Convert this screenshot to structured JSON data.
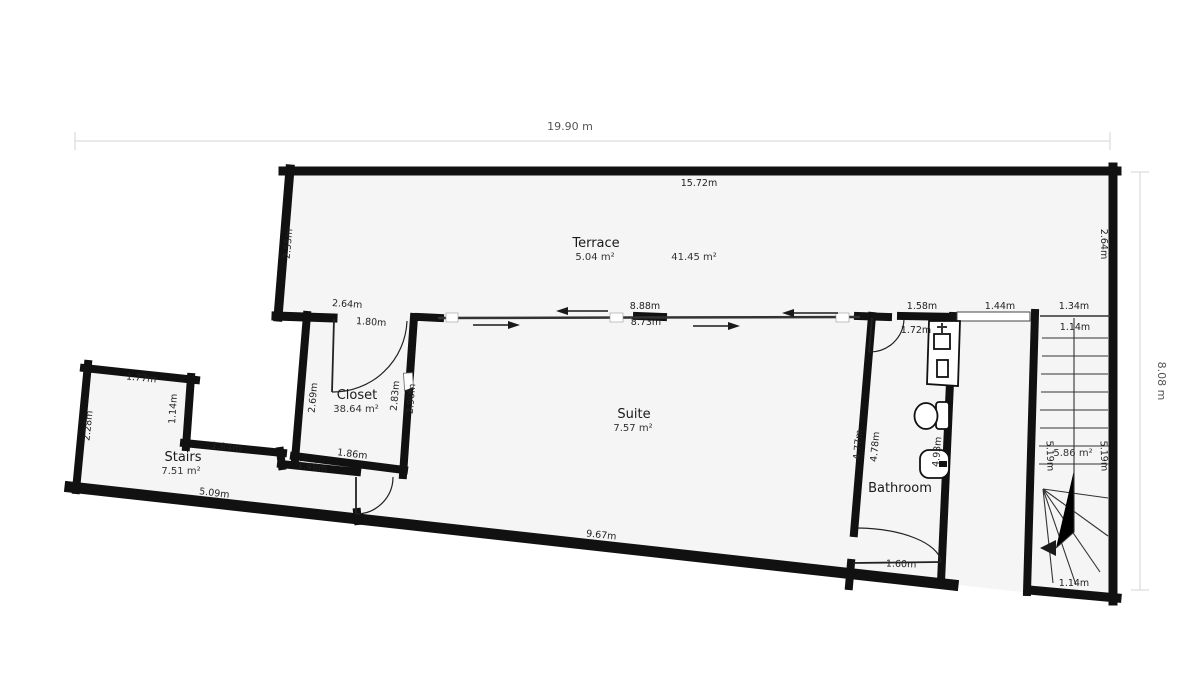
{
  "colors": {
    "wall": "#111111",
    "room_fill": "#f5f5f5",
    "dim_line": "#dddddd",
    "dim_text": "#555555",
    "label_text": "#1a1a1a"
  },
  "overall": {
    "width_label": "19.90 m",
    "height_label": "8.08 m"
  },
  "rooms": {
    "terrace": {
      "name": "Terrace",
      "area": "5.04 m²"
    },
    "level": {
      "area": "41.45 m²"
    },
    "suite": {
      "name": "Suite",
      "area": "7.57 m²"
    },
    "closet": {
      "name": "Closet",
      "area": "38.64 m²"
    },
    "stairs": {
      "name": "Stairs",
      "area": "7.51 m²"
    },
    "bathroom": {
      "name": "Bathroom"
    },
    "stairwell": {
      "area": "5.86 m²"
    }
  },
  "dims": {
    "terrace_top": "15.72m",
    "terrace_left": "2.55m",
    "terrace_right": "2.64m",
    "closet_door_outer": "2.64m",
    "closet_door_inner": "1.80m",
    "slider_outer": "8.88m",
    "slider_inner": "8.73m",
    "bath_top_wall": "1.58m",
    "opening_top": "1.44m",
    "stair_top_outer": "1.34m",
    "stair_top_inner": "1.14m",
    "bath_door_top": "1.72m",
    "closet_left": "2.69m",
    "closet_right_upper": "2.83m",
    "closet_right_lower": "2.90m",
    "stairs_top": "1.77m",
    "stairs_notch": "1.14m",
    "stairs_left": "2.28m",
    "stairs_step": "1.84m",
    "closet_bottom": "1.86m",
    "stairs_inner": "1.48m",
    "stairs_bottom": "5.09m",
    "suite_bottom": "9.67m",
    "suite_right_outer": "4.77m",
    "suite_right_inner": "4.78m",
    "bath_right": "4.93m",
    "bath_door_bottom": "1.60m",
    "stairwell_left": "5.19m",
    "stairwell_right": "5.19m",
    "stair_bottom": "1.14m"
  }
}
